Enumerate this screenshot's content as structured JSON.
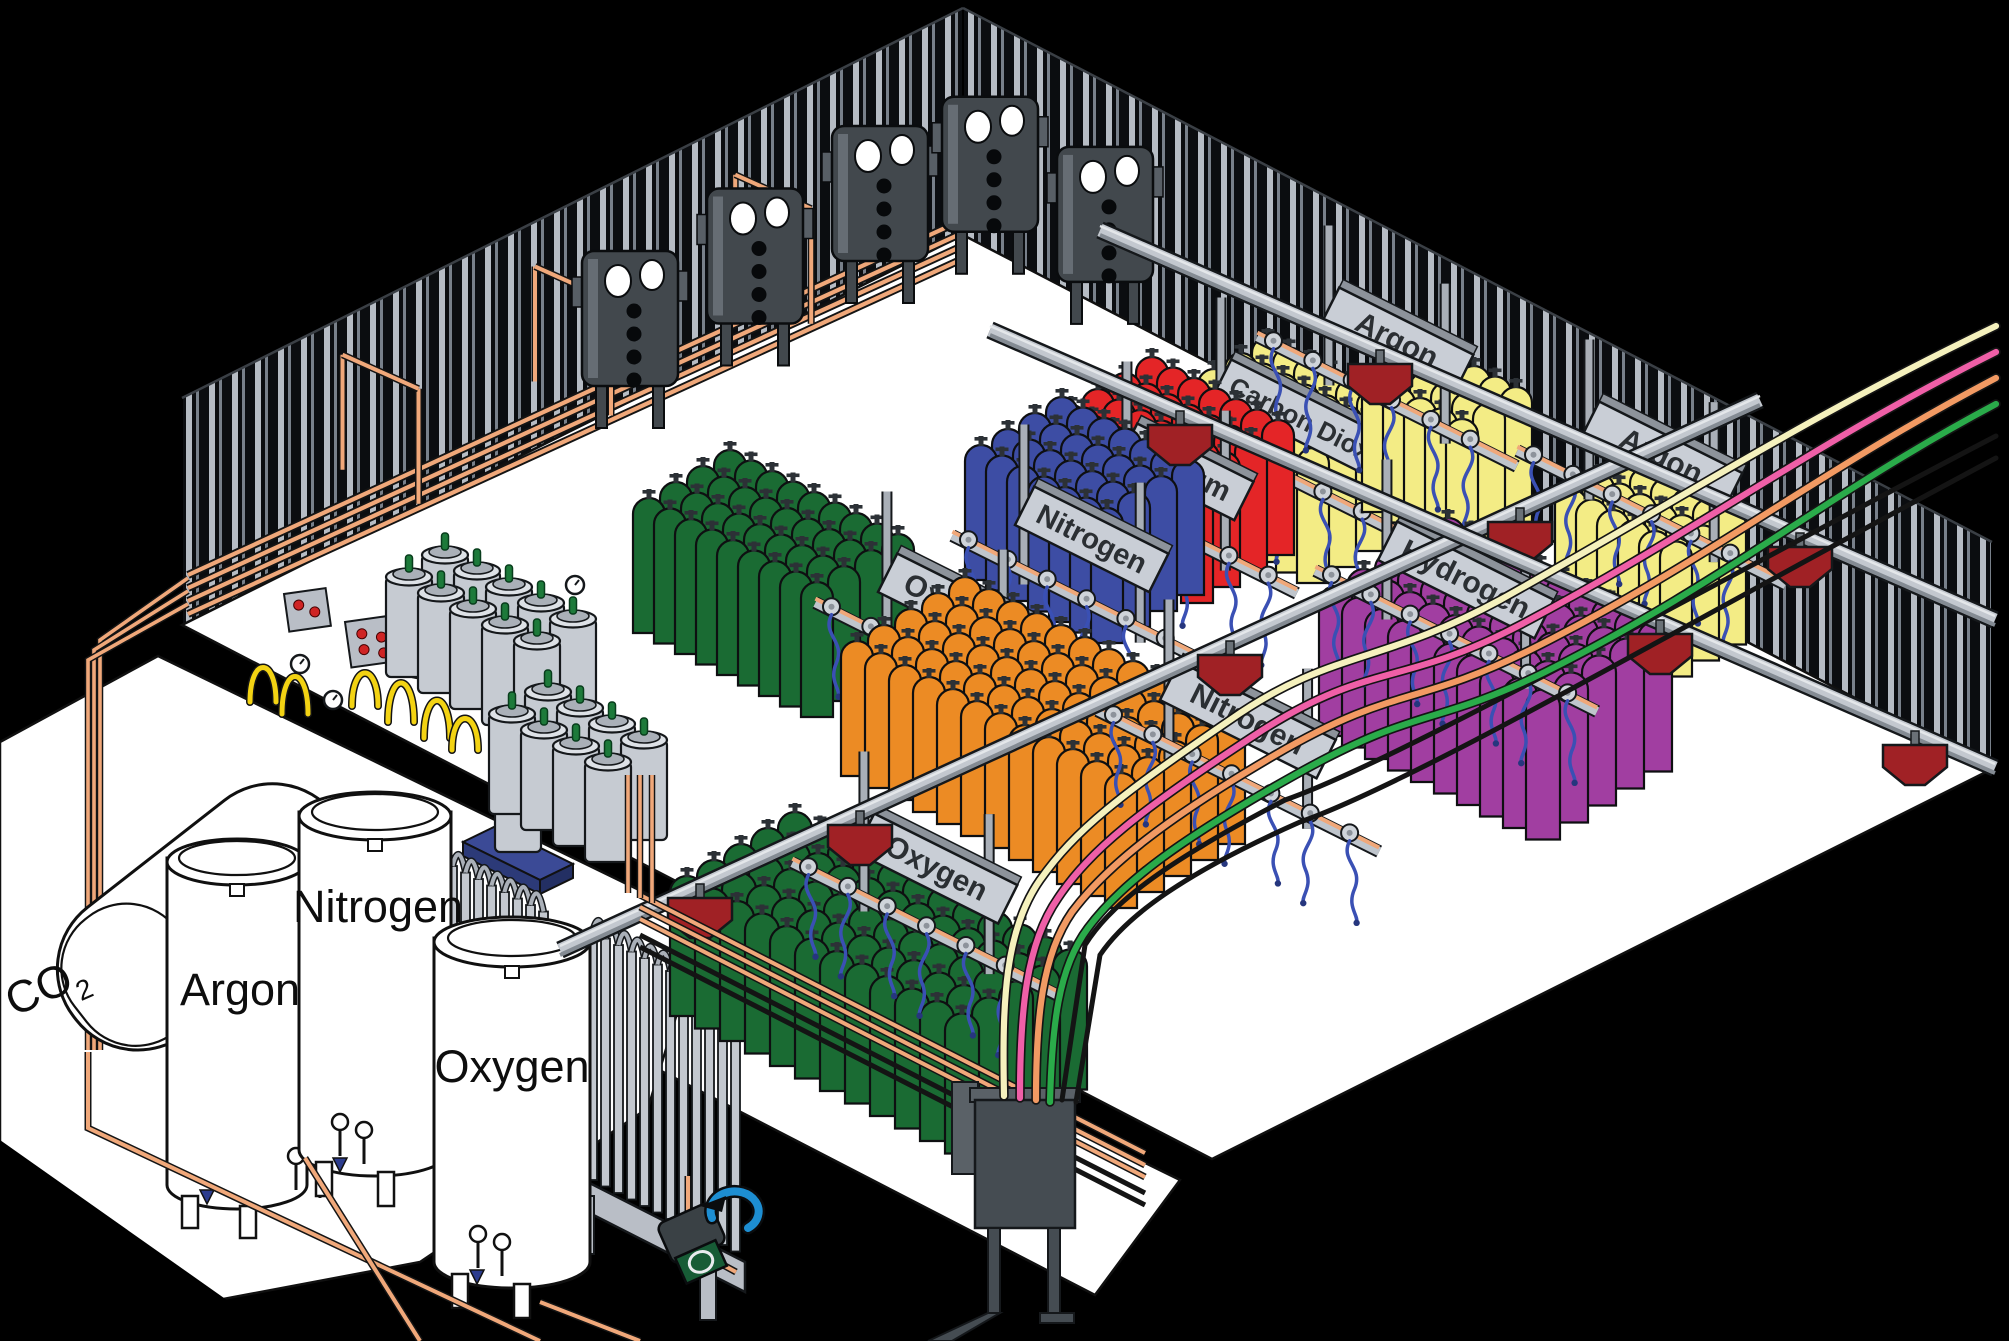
{
  "diagram": {
    "subject": "Isometric cutaway illustration of an industrial gas cylinder filling plant",
    "building": {
      "wall_base_color": "#0b0d10",
      "wall_stripe_colors": [
        "#b6bcc4",
        "#78808a"
      ],
      "floor_color": "#ffffff"
    },
    "outdoor_storage": {
      "co2_tank": {
        "label_main": "CO",
        "label_sub": "2"
      },
      "tanks": [
        {
          "label": "Argon"
        },
        {
          "label": "Nitrogen"
        },
        {
          "label": "Oxygen"
        }
      ],
      "equipment": [
        {
          "name": "liquid-cylinder-dewars"
        },
        {
          "name": "ambient-vaporizer-small"
        },
        {
          "name": "ambient-vaporizer-tall"
        },
        {
          "name": "transfer-pump"
        },
        {
          "name": "weighing-pallet"
        }
      ]
    },
    "filling_stations": [
      {
        "id": "oxygen-upper",
        "label": "Oxygen",
        "cylinder_color": "#1a6b33"
      },
      {
        "id": "nitrogen-blue",
        "label": "Nitrogen",
        "cylinder_color": "#3d4da4"
      },
      {
        "id": "helium",
        "label": "Helium",
        "cylinder_color": "#e42527"
      },
      {
        "id": "carbon-dioxide",
        "label": "Carbon Dioxide",
        "cylinder_color": "#f3ec85"
      },
      {
        "id": "argon-top",
        "label": "Argon",
        "cylinder_color": "#f3ec85"
      },
      {
        "id": "hydrogen",
        "label": "Hydrogen",
        "cylinder_color": "#a13ea1"
      },
      {
        "id": "nitrogen-orange",
        "label": "Nitrogen",
        "cylinder_color": "#ec8b24"
      },
      {
        "id": "argon-right",
        "label": "Argon",
        "cylinder_color": "#f3ec85"
      },
      {
        "id": "oxygen-lower",
        "label": "Oxygen",
        "cylinder_color": "#1a6b33"
      }
    ],
    "piping": {
      "copper": "#f0a87a",
      "hose_blue": "#3a50b4",
      "hose_yellow": "#f3d313",
      "supply_line_colors": [
        "#f5f1bd",
        "#ef5fa7",
        "#f29a63",
        "#2aab4a"
      ],
      "line_black": "#141414"
    },
    "conveyor": {
      "rail_color": "#c3c8cf",
      "cart_color": "#a02125"
    },
    "wall_panels": {
      "body_color": "#42484d",
      "gauge_color": "#ffffff",
      "count": 5
    },
    "dewar_color": "#c6cbd2",
    "pump_colors": {
      "body": "#3a4145",
      "face": "#175c36",
      "hose": "#1d8ed2"
    },
    "pallet_color": "#3b4a96"
  }
}
